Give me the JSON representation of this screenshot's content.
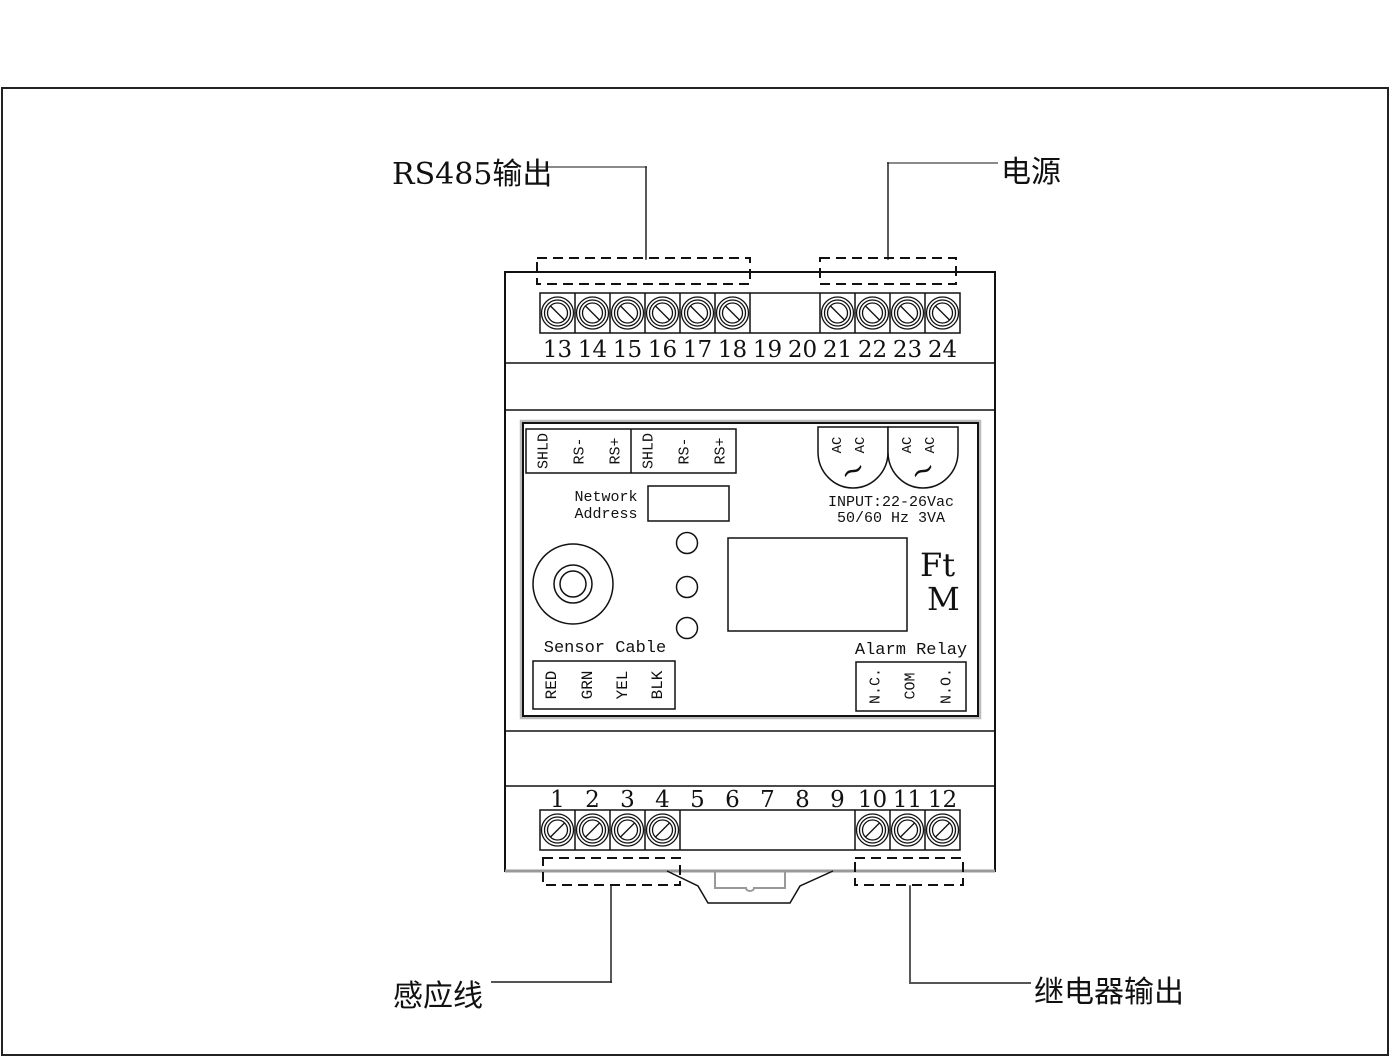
{
  "colors": {
    "line": "#111111",
    "leader": "#8a8a8a",
    "background": "#ffffff"
  },
  "callouts": {
    "rs485_output": "RS485输出",
    "power": "电源",
    "sensor_wire": "感应线",
    "relay_output": "继电器输出"
  },
  "terminals": {
    "top": [
      "13",
      "14",
      "15",
      "16",
      "17",
      "18",
      "19",
      "20",
      "21",
      "22",
      "23",
      "24"
    ],
    "bottom": [
      "1",
      "2",
      "3",
      "4",
      "5",
      "6",
      "7",
      "8",
      "9",
      "10",
      "11",
      "12"
    ]
  },
  "rs485_block": {
    "pins": [
      "SHLD",
      "RS-",
      "RS+",
      "SHLD",
      "RS-",
      "RS+"
    ]
  },
  "network_address": {
    "line1": "Network",
    "line2": "Address"
  },
  "power_block": {
    "ac_pins": [
      "AC",
      "AC",
      "AC",
      "AC"
    ],
    "wave": "~",
    "input_line1": "INPUT:22-26Vac",
    "input_line2": "50/60 Hz 3VA"
  },
  "display_area": {
    "unit_line1": "Ft",
    "unit_line2": "M"
  },
  "sensor_cable": {
    "title": "Sensor Cable",
    "pins": [
      "RED",
      "GRN",
      "YEL",
      "BLK"
    ]
  },
  "alarm_relay": {
    "title": "Alarm Relay",
    "pins": [
      "N.C.",
      "COM",
      "N.O."
    ]
  }
}
